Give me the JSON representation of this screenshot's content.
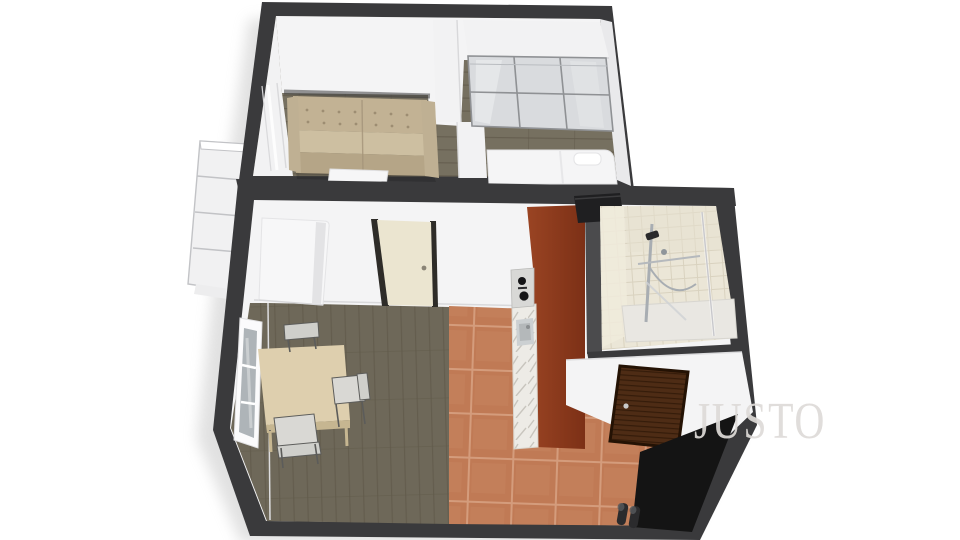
{
  "image": {
    "kind": "3d-floor-plan-render",
    "description": "Isometric 3D floor plan of a small studio apartment, viewed from above"
  },
  "watermark": {
    "text": "JUSTO"
  },
  "scene": {
    "rooms": [
      "bedroom-living-area",
      "dining-kitchen-area",
      "bathroom",
      "entrance-hall",
      "balcony"
    ],
    "elements": [
      "balcony",
      "sofa",
      "floor-mat",
      "partition-wall",
      "sliding-door-wardrobe",
      "bed",
      "window",
      "white-cabinet",
      "interior-door",
      "dining-table",
      "dining-chairs",
      "kitchen-counter",
      "stove",
      "kitchen-sink",
      "bathroom-vanity",
      "shower",
      "entrance-door",
      "entry-mat",
      "shoes"
    ]
  },
  "palette": {
    "wall-dark": "#3a3a3c",
    "wall-face": "#f4f4f5",
    "wall-face-shade": "#e9e9eb",
    "partition-white": "#f2f2f3",
    "wood-top-base": "#767060",
    "wood-low-base": "#6e6859",
    "wood-line": "#5f5949",
    "tile-base": "#c07a55",
    "tile-grout": "#d49c7c",
    "sofa-body": "#c2b294",
    "sofa-seat": "#cdbfa1",
    "sofa-front": "#b5a587",
    "sofa-arm": "#bfb093",
    "sofa-tuft": "#9d8d72",
    "mat-white": "#f6f6f7",
    "bed-white": "#f5f5f6",
    "wardrobe-panel": "#d9dbde",
    "wardrobe-frame": "#8f9194",
    "cabinet-white": "#f7f7f8",
    "door-cream": "#ebe5d0",
    "door-post": "#2e2c28",
    "table-wood": "#decfae",
    "table-edge": "#c6b691",
    "chair-seat": "#d9d8d4",
    "chair-back": "#cfcfcb",
    "chair-frame": "#5c5c5a",
    "counter-rust-1": "#9a4423",
    "counter-rust-2": "#7c3016",
    "marble-base": "#edebe6",
    "marble-vein": "#bfbcb4",
    "stove-black": "#151517",
    "sink-gray": "#ccd0d2",
    "bath-tile-base": "#ebe6d7",
    "bath-tile-line": "#d9d2bf",
    "shower-chrome": "#a8adb2",
    "shower-dark": "#2a2a2c",
    "glass-line": "#c8c8cc",
    "kb-wall": "#4b4b4d",
    "vanity-black": "#1f1f21",
    "entry-door-base": "#4e2c15",
    "entry-door-grain": "#351c0a",
    "entry-mat": "#141414",
    "shoe-dark": "#2b2b2d",
    "shoe-light": "#55575a",
    "balcony-line": "#c2c3c6",
    "balcony-fill": "#f1f1f2",
    "window-pane": "#aeb4b8",
    "watermark": "#dedbd8"
  }
}
